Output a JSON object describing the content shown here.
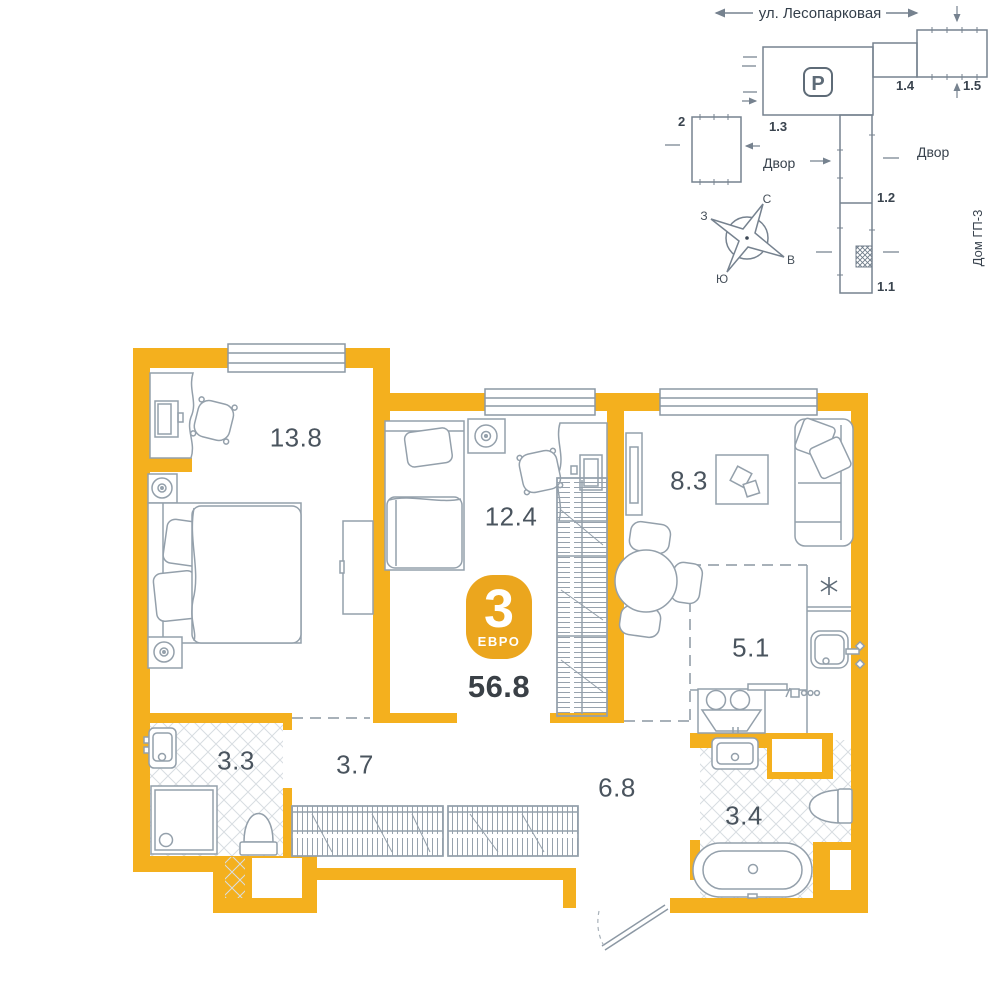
{
  "site_plan": {
    "street": "ул. Лесопарковая",
    "parking_label": "P",
    "building_13": "1.3",
    "building_14": "1.4",
    "building_15": "1.5",
    "building_2": "2",
    "building_12": "1.2",
    "building_11": "1.1",
    "yard_left": "Двор",
    "yard_right": "Двор",
    "house_name": "Дом ГП-3",
    "compass": {
      "north": "С",
      "east": "В",
      "south": "Ю",
      "west": "З"
    }
  },
  "badge": {
    "rooms_count": "3",
    "layout_type": "ЕВРО",
    "total_area": "56.8"
  },
  "rooms": [
    {
      "name": "bedroom-1",
      "area": "13.8"
    },
    {
      "name": "bedroom-2",
      "area": "12.4"
    },
    {
      "name": "living-room",
      "area": "8.3"
    },
    {
      "name": "kitchen",
      "area": "5.1"
    },
    {
      "name": "bathroom-1",
      "area": "3.3"
    },
    {
      "name": "hallway",
      "area": "3.7"
    },
    {
      "name": "corridor",
      "area": "6.8"
    },
    {
      "name": "bathroom-2",
      "area": "3.4"
    }
  ],
  "colors": {
    "wall": "#F4B01E",
    "badge": "#EBA61E",
    "line": "#94A0AB",
    "site_line": "#76828F",
    "text_dark": "#39434E"
  }
}
